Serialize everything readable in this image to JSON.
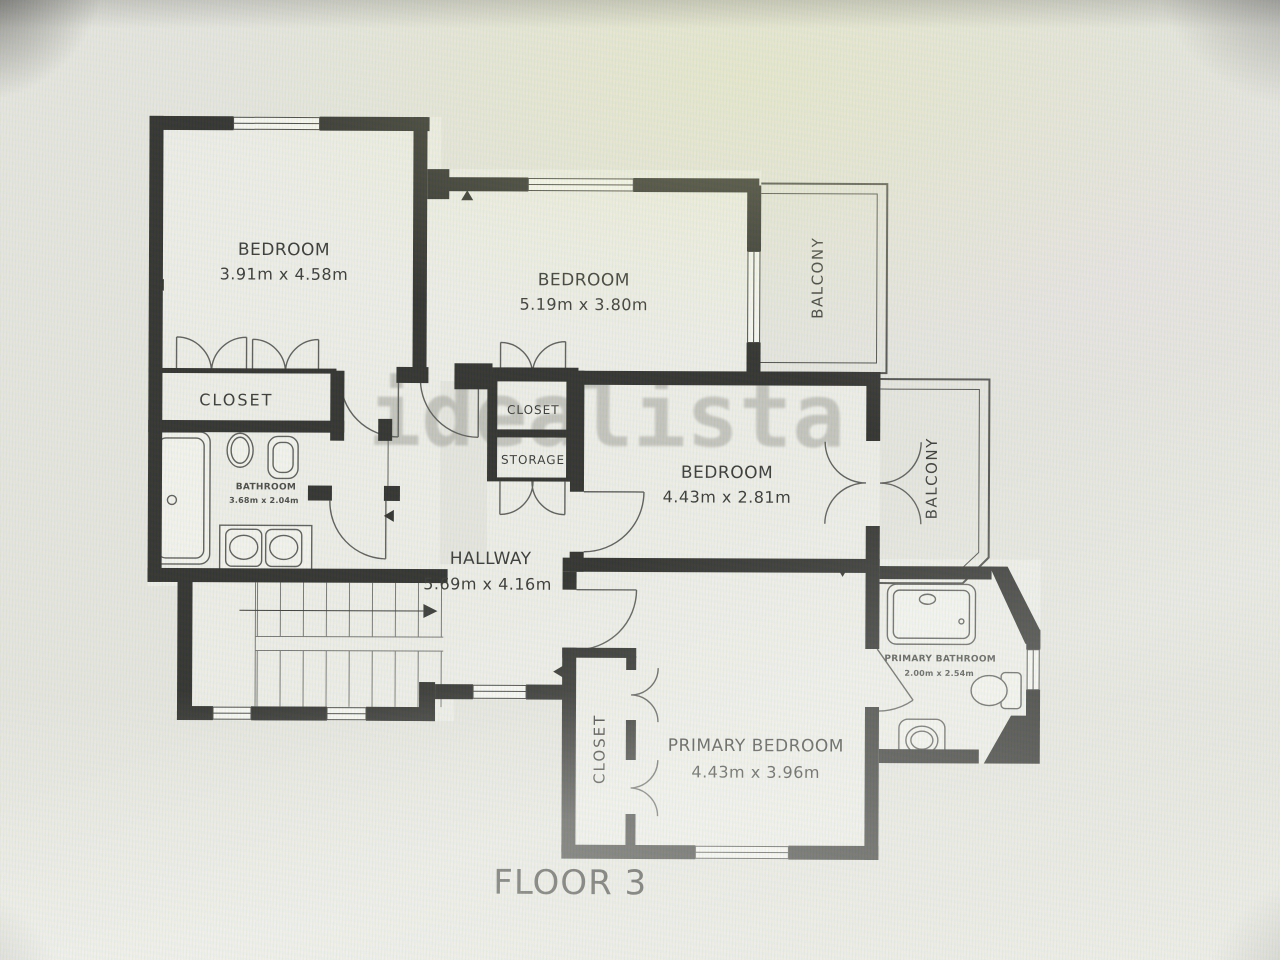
{
  "watermark": {
    "text": "idealista"
  },
  "floor_label": "FLOOR 3",
  "rooms": {
    "bedroom1": {
      "name": "BEDROOM",
      "dims": "3.91m x 4.58m"
    },
    "bedroom2": {
      "name": "BEDROOM",
      "dims": "5.19m x 3.80m"
    },
    "bedroom3": {
      "name": "BEDROOM",
      "dims": "4.43m x 2.81m"
    },
    "primary_bedroom": {
      "name": "PRIMARY BEDROOM",
      "dims": "4.43m x 3.96m"
    },
    "hallway": {
      "name": "HALLWAY",
      "dims": "5.69m x 4.16m"
    },
    "bathroom": {
      "name": "BATHROOM",
      "dims": "3.68m x 2.04m"
    },
    "primary_bathroom": {
      "name": "PRIMARY BATHROOM",
      "dims": "2.00m x 2.54m"
    },
    "closet_bedroom1": {
      "name": "CLOSET"
    },
    "closet_bedroom2": {
      "name": "CLOSET"
    },
    "storage": {
      "name": "STORAGE"
    },
    "closet_primary": {
      "name": "CLOSET"
    },
    "balcony_top": {
      "name": "BALCONY"
    },
    "balcony_right": {
      "name": "BALCONY"
    }
  },
  "colors": {
    "wall": "#1d1d1d",
    "floor": "#f0f0ed",
    "line": "#4f4f4f",
    "watermark": "#8a8a85"
  }
}
